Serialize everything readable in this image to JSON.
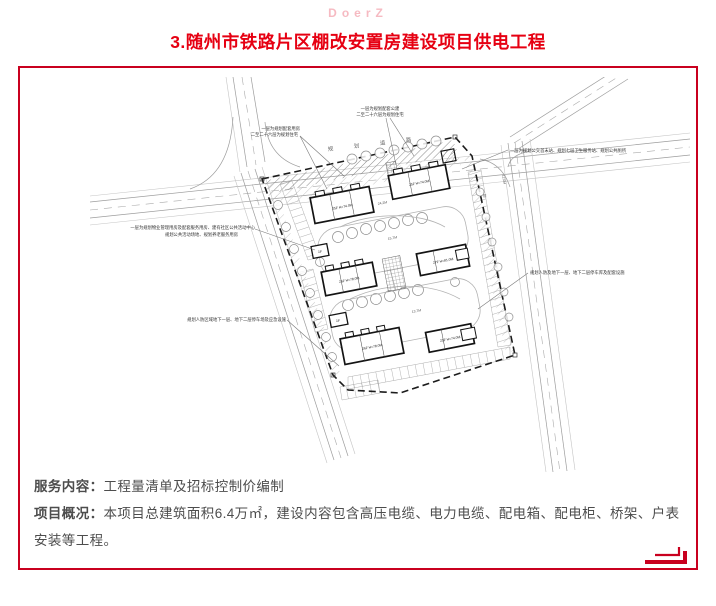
{
  "watermark": "DoerZ",
  "title": "3.随州市铁路片区棚改安置房建设项目供电工程",
  "plan": {
    "road_name_chars": [
      "规",
      "划",
      "道",
      "路"
    ],
    "side_road_chars": [
      "规",
      "划",
      "路"
    ],
    "annotations": [
      {
        "id": "top-left",
        "lines": [
          "一层为规划配套用房",
          "二至二十六层为规划住宅"
        ]
      },
      {
        "id": "top-center",
        "lines": [
          "一层为规划配套公建",
          "二至二十六层为规划住宅"
        ]
      },
      {
        "id": "right-top",
        "lines": [
          "一层为规划公交首末站、规划七层卫生服务站、规划公共厕所"
        ]
      },
      {
        "id": "right-mid",
        "lines": [
          "规划人防及地下一层、地下二层停车库及配套设施"
        ]
      },
      {
        "id": "left-mid",
        "lines": [
          "一层为规划物业管理用房及配套服务用房、建有社区公共活动中心",
          "规划公共活动场地、规划养老服务用房"
        ]
      },
      {
        "id": "left-bottom",
        "lines": [
          "规划人防区域地下一层、地下二层停车场及应急设施"
        ]
      }
    ],
    "buildings": [
      {
        "label": "25F H=74.0M"
      },
      {
        "label": "25F H=74.0M"
      },
      {
        "label": "26F H=78.0M"
      },
      {
        "label": "27F H=81.0M"
      },
      {
        "label": "26F H=78.0M"
      },
      {
        "label": "25F H=74.0M"
      },
      {
        "label": "1F"
      },
      {
        "label": "1F"
      }
    ],
    "dimensions": [
      "24.2M",
      "15.7M",
      "13.7M",
      "12.0M"
    ]
  },
  "footer": {
    "service_label": "服务内容：",
    "service_value": "工程量清单及招标控制价编制",
    "overview_label": "项目概况：",
    "overview_value": "本项目总建筑面积6.4万㎡，建设内容包含高压电缆、电力电缆、配电箱、配电柜、桥架、户表安装等工程。"
  },
  "colors": {
    "accent_red": "#C9001F",
    "title_red": "#E60012",
    "watermark_pink": "#F6BAC2",
    "text_gray": "#4D4D4D"
  }
}
